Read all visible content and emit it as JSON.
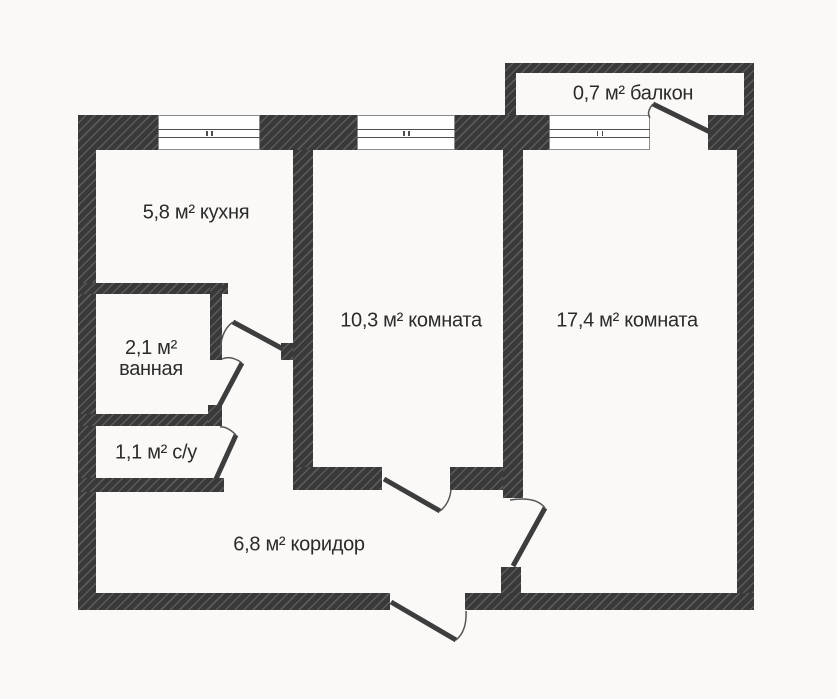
{
  "rooms": {
    "balcony": {
      "label": "0,7 м² балкон"
    },
    "kitchen": {
      "label": "5,8 м² кухня"
    },
    "room_small": {
      "label": "10,3 м² комната"
    },
    "room_large": {
      "label": "17,4 м² комната"
    },
    "bathroom": {
      "area": "2,1 м²",
      "name": "ванная"
    },
    "wc": {
      "label": "1,1 м² с/у"
    },
    "corridor": {
      "label": "6,8 м² коридор"
    }
  },
  "colors": {
    "wall": "#393939",
    "hatch": "#5a5a5a",
    "background": "#faf9f7",
    "door_line": "#3d3d3d",
    "arc_line": "#555555",
    "window_frame": "#8b8b8b",
    "glazing": "#4f4f4f",
    "text": "#2b2b2b"
  }
}
